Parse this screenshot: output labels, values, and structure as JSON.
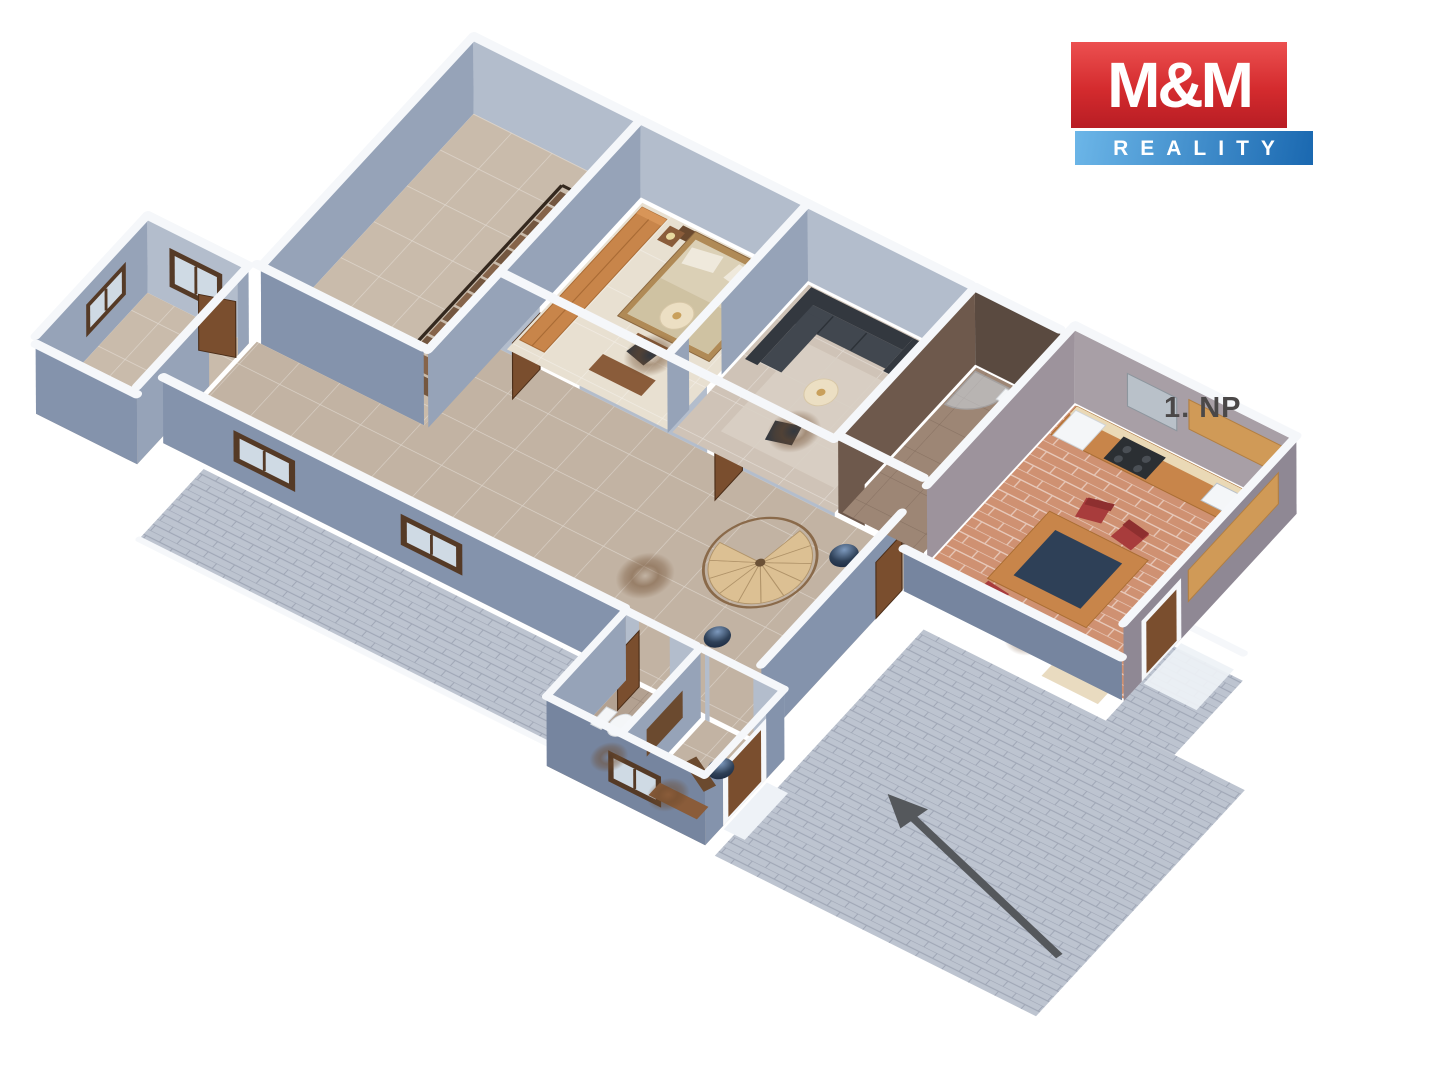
{
  "app": {
    "type": "3d-floor-plan-rendering",
    "background": "#ffffff"
  },
  "branding": {
    "logo_top": "M&M",
    "logo_bottom": "REALITY",
    "red_gradient_top": "#ec5050",
    "red_gradient_bottom": "#b81d24",
    "blue_gradient_left": "#6cb6e8",
    "blue_gradient_right": "#1a68b0",
    "text_color": "#ffffff"
  },
  "floor_label": {
    "text": "1. NP",
    "color": "#4b4848"
  },
  "entry_arrow": {
    "color": "#55585c",
    "meaning": "entrance-direction"
  },
  "scene": {
    "rooms": [
      "large-room-with-straight-staircase",
      "side-room",
      "bedroom",
      "living-room",
      "bathroom",
      "kitchen-dining",
      "corridor-with-spiral-staircase",
      "wc",
      "entry-vestibule",
      "paved-walkway",
      "paved-terrace"
    ]
  },
  "palette": {
    "wall_light": "#b3bdcc",
    "wall_mid": "#96a3b8",
    "wall_ext": "#8493ac",
    "wall_shadow": "#76859f",
    "cap": "#f5f7fa",
    "floor_tile": "#c9bbab",
    "floor_cream": "#e8e0d1",
    "floor_taupe": "#cfc3b7",
    "floor_hall": "#c2b3a3",
    "floor_bath": "#9d8675",
    "floor_wc": "#b3a191",
    "floor_terra": "#cf9172",
    "paving": "#bdc4d0",
    "kit_wall_n": "#a89fa6",
    "kit_wall_w": "#9d939c",
    "kit_wall_e": "#8f8894",
    "bath_wall": "#5a4a40",
    "bath_wall_light": "#6e594c",
    "wood": "#c8854a",
    "wood_top": "#d89558",
    "wood_dark": "#8a5c3a",
    "wood_deep": "#6b4a2f",
    "counter_top": "#ead9b6",
    "stair_dark": "#745740",
    "stair_mid": "#86644a",
    "spiral": "#dcc093",
    "spiral_edge": "#b1946a",
    "rail": "#8a6a4a",
    "sofa": "#41474f",
    "sofa_dark": "#33383f",
    "navy": "#2e4057",
    "chair_red": "#a83c3c",
    "chair_red_dark": "#8e2f2f",
    "white_fixture": "#f4f6f8",
    "steel": "#b9c1c9",
    "glass": "#cfdae4",
    "frame": "#553a26",
    "door_leaf": "#7a4e2e",
    "lamp": "#ecdfc3",
    "lamp_dot": "#c9a05c",
    "rug": "#d8cfc4",
    "mattress": "#dbd0b6",
    "blanket": "#cfc2a2",
    "pillow": "#efe9dc",
    "bed_frame": "#b08a56",
    "step_cream": "#e9dbc0"
  }
}
